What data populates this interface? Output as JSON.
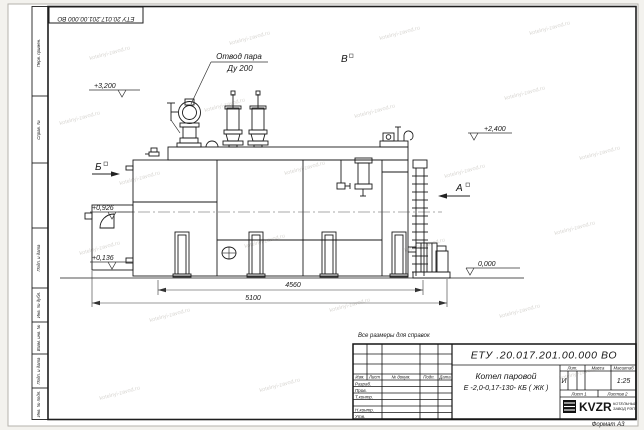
{
  "page": {
    "top_stamp": "ЕТУ 20.017.201.00.000  ВО",
    "reference_note": "Все размеры для справок",
    "format_note": "Формат А3",
    "watermark": "kotelnyi-zavod.ru",
    "margin_labels": [
      "Перв. примен.",
      "Справ. №",
      "",
      "Подп. и дата",
      "Инв. № дубл.",
      "Взам. инв. №",
      "Подп. и дата",
      "Инв. № подл."
    ]
  },
  "drawing": {
    "callout": {
      "line1": "Отвод пара",
      "line2": "Ду 200"
    },
    "view_labels": {
      "a": "А",
      "b": "Б",
      "v": "В"
    },
    "elevations": {
      "e3200": "+3,200",
      "e2400": "+2,400",
      "e0926": "+0,926",
      "e0136": "+0,136",
      "e0000": "0,000"
    },
    "dimensions": {
      "d4560": "4560",
      "d5100": "5100"
    }
  },
  "title_block": {
    "doc_number": "ЕТУ .20.017.201.00.000  ВО",
    "product_line1": "Котел паровой",
    "product_line2": "Е -2,0-0,17-130- КБ ( ЖК )",
    "col_izm": "Изм.",
    "col_list": "Лист",
    "col_doc": "№ докум.",
    "col_podp": "Подп.",
    "col_data": "Дата",
    "row_razrab": "Разраб.",
    "row_prov": "Пров.",
    "row_tkontr": "Т.контр.",
    "row_nkontr": "Н.контр.",
    "row_utv": "Утв.",
    "lit_header": "Лит.",
    "mass_header": "Масса",
    "scale_header": "Масштаб",
    "lit_value": "И",
    "scale_value": "1:25",
    "sheet_label": "Лист 1",
    "sheets_label": "Листов 2",
    "logo": {
      "name": "KVZR",
      "sub1": "КОТЕЛЬНЫЙ",
      "sub2": "ЗАВОД РЭП"
    }
  }
}
